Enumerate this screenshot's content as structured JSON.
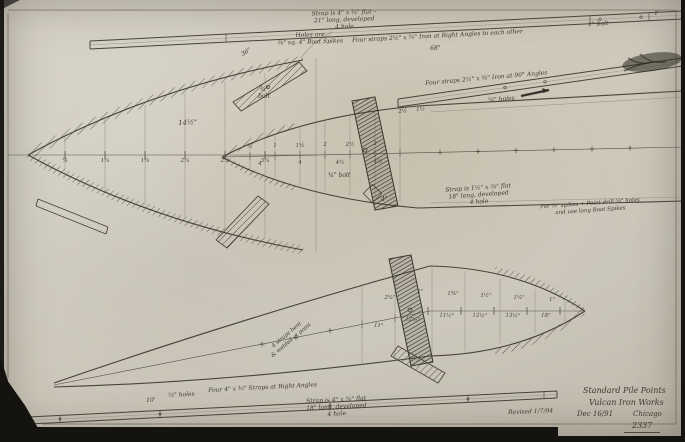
{
  "title_block": {
    "company_line1": "Standard Pile Points",
    "company_line2": "Vulcan Iron Works",
    "date": "Dec 16/91",
    "city": "Chicago",
    "drawing_number": "2337",
    "revised_note": "Revised 1/7/94"
  },
  "annotations": {
    "top_strap": "Strap is 4\" x ⅜\" flat –\n21\" long, developed\n4 hole",
    "top_holes": "Holes are\n⅝\" sq. 4\" Boat Spikes",
    "top_bar": "Four straps 2½\" x ⅜\" Iron at Right Angles to each other",
    "top_bar_dim": "68\"",
    "top_bar_bolt": "1\" bolt",
    "top_bar_end": "1'",
    "strap_36": "36\"",
    "bolt_34": "¾\"\nbolt",
    "dim_14half": "14½\"",
    "bar2": "Four straps 2½\" x ⅜\" Iron at 90° Angles",
    "bar2_holes": "⅝\" holes",
    "mid_strap": "Strap is 1½\" x ⅜\" flat\n18\" long, developed\n4 hole",
    "mid_bolt": "¾\" bolt",
    "mid_diamond": "4\"",
    "right_note": "For ⅝\" spikes + Point drill ⅝\" holes\nand use long Boat Spikes",
    "bottom_bar": "Four 4\" x ⅜\" Straps at Right Angles",
    "bottom_bar_holes": "⅝\" holes",
    "bottom_bar_len": "10'",
    "bottom_strap": "Strap is 4\" x ⅜\" flat\n18\" long, developed\n4 hole",
    "diag_note": "4 straps bent\n& welded at point"
  },
  "dims": {
    "big_ord": [
      "¾",
      "1¼",
      "1¾",
      "2¼",
      "2¾",
      "3¼"
    ],
    "mid_upper": [
      "½",
      "1",
      "1½",
      "2",
      "2½",
      "3"
    ],
    "mid_lower": [
      "4",
      "4",
      "4½",
      "4½"
    ],
    "bar2_end": [
      "2½",
      "1½"
    ],
    "bottom_ord": [
      "1\"",
      "1¼\"",
      "1½\"",
      "1¾\"",
      "2\"",
      "2¼\""
    ],
    "bottom_stations": [
      "18\"",
      "13½\"",
      "12½\"",
      "11½\"",
      "12½\"",
      "11\""
    ]
  },
  "colors": {
    "paper": "#cdc8bb",
    "pencil": "#474338",
    "hatch": "#5c574b",
    "scan_edge": "#14130f"
  }
}
